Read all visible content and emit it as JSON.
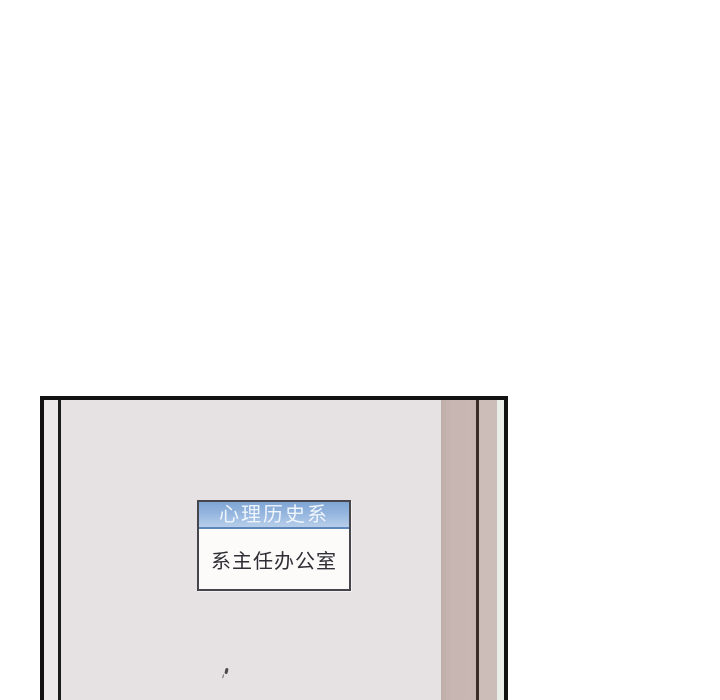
{
  "scene": {
    "description": "comic-panel-door-with-sign",
    "background": "#ffffff"
  },
  "panel": {
    "border_color": "#121212",
    "door_color": "#e6e1e2",
    "wall_strip_color": "#edeaec",
    "frame_taupe_1": "#c6b5b0",
    "frame_taupe_2": "#cdbdb8",
    "frame_dark_line": "#3b2d28",
    "edge_light": "#e9ede8"
  },
  "door_sign": {
    "header": "心理历史系",
    "body": "系主任办公室",
    "header_bg_top": "#7fa5d4",
    "header_bg_bottom": "#b7cee9",
    "header_divider": "#5f86bb",
    "header_text_color": "#eff5fc",
    "body_bg": "#fcfbfa",
    "body_text_color": "#2e2e34",
    "border_color": "#45454b"
  }
}
